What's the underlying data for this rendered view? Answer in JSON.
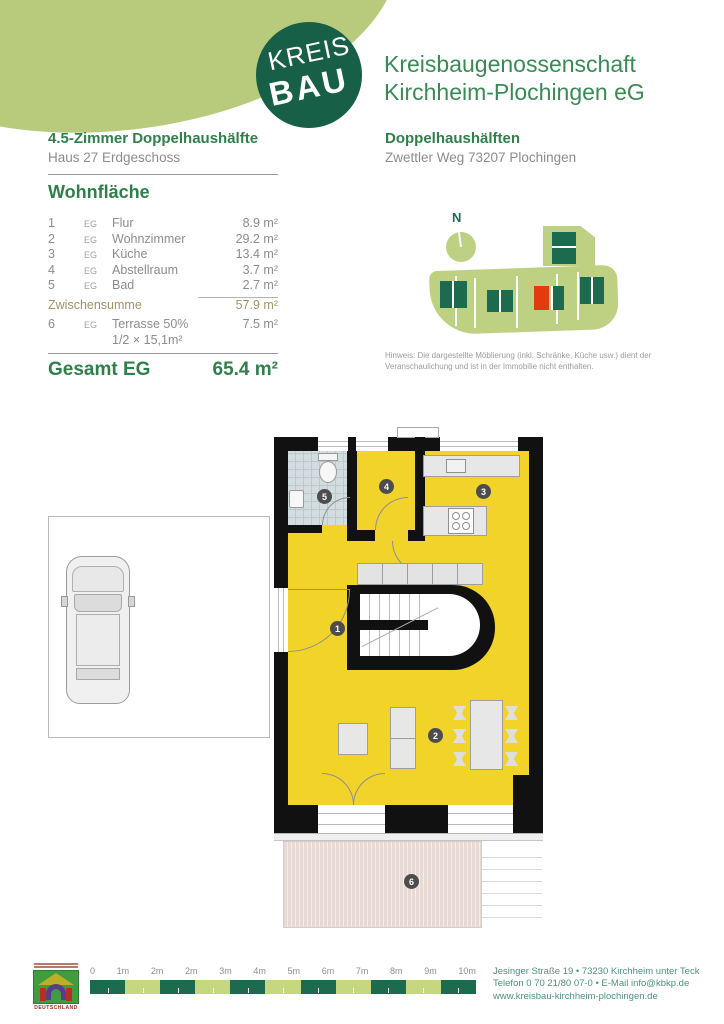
{
  "header": {
    "logo_top": "KREIS",
    "logo_bottom": "BAU",
    "org_line1": "Kreisbaugenossenschaft",
    "org_line2": "Kirchheim-Plochingen eG"
  },
  "left": {
    "title": "4.5-Zimmer Doppelhaushälfte",
    "subtitle": "Haus 27 Erdgeschoss",
    "section_title": "Wohnfläche",
    "rows": [
      {
        "num": "1",
        "floor": "EG",
        "name": "Flur",
        "area": "8.9 m²"
      },
      {
        "num": "2",
        "floor": "EG",
        "name": "Wohnzimmer",
        "area": "29.2 m²"
      },
      {
        "num": "3",
        "floor": "EG",
        "name": "Küche",
        "area": "13.4 m²"
      },
      {
        "num": "4",
        "floor": "EG",
        "name": "Abstellraum",
        "area": "3.7 m²"
      },
      {
        "num": "5",
        "floor": "EG",
        "name": "Bad",
        "area": "2.7 m²"
      }
    ],
    "subtotal": {
      "label": "Zwischensumme",
      "value": "57.9 m²"
    },
    "terrace_row": {
      "num": "6",
      "floor": "EG",
      "name": "Terrasse 50%",
      "detail": "1/2 × 15,1m²",
      "area": "7.5 m²"
    },
    "total": {
      "label": "Gesamt EG",
      "value": "65.4 m²"
    }
  },
  "right": {
    "title": "Doppelhaushälften",
    "subtitle": "Zwettler Weg  73207 Plochingen",
    "compass": "N",
    "hinweis_line1": "Hinweis: Die dargestellte Möblierung (inkl. Schränke, Küche usw.) dient der",
    "hinweis_line2": "Veranschaulichung und ist in der Immobilie nicht enthalten."
  },
  "plan": {
    "badges": [
      "1",
      "2",
      "3",
      "4",
      "5",
      "6"
    ]
  },
  "footer": {
    "scale_labels": [
      "0",
      "1m",
      "2m",
      "2m",
      "3m",
      "4m",
      "5m",
      "6m",
      "7m",
      "8m",
      "9m",
      "10m"
    ],
    "deutschland": "DEUTSCHLAND",
    "address_line1": "Jesinger Straße 19 • 73230 Kirchheim unter Teck",
    "address_line2": "Telefon 0 70 21/80 07-0 • E-Mail info@kbkp.de",
    "address_line3": "www.kreisbau-kirchheim-plochingen.de"
  },
  "colors": {
    "brand_green": "#2f7f4a",
    "logo_green": "#175f47",
    "blob_green": "#b8cb7d",
    "site_plot_green": "#bed183",
    "site_house_green": "#1d6b4e",
    "highlight_red": "#e23b0f",
    "plan_yellow": "#f2d32a",
    "wall_black": "#111111",
    "terrace_beige": "#e7d9d3",
    "scale_dark": "#1d6b4e",
    "scale_light": "#c6d87f",
    "text_gray": "#8c8c8c",
    "subtotal_olive": "#a09366",
    "address_teal": "#4f9181"
  }
}
